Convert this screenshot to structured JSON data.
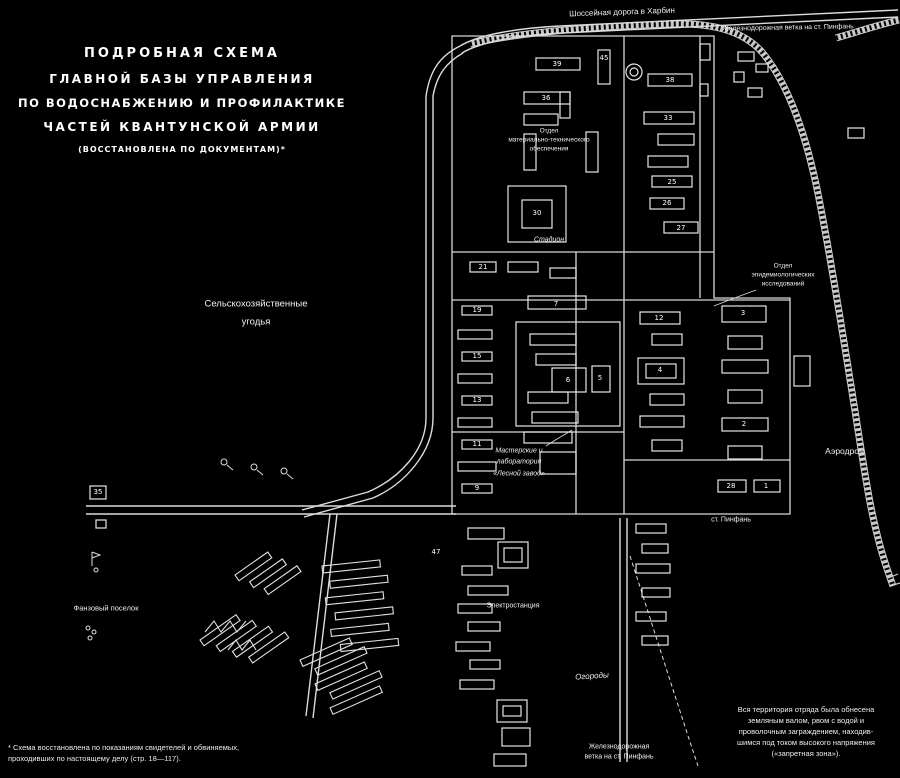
{
  "title": {
    "lines": [
      "ПОДРОБНАЯ СХЕМА",
      "ГЛАВНОЙ БАЗЫ УПРАВЛЕНИЯ",
      "ПО ВОДОСНАБЖЕНИЮ И ПРОФИЛАКТИКЕ",
      "ЧАСТЕЙ КВАНТУНСКОЙ АРМИИ",
      "(ВОССТАНОВЛЕНА ПО ДОКУМЕНТАМ)*"
    ]
  },
  "annotation": {
    "lines": [
      "Вся территория отряда была обнесена",
      "земляным валом, рвом с водой и",
      "проволочным заграждением, находив-",
      "шимся под током высокого напряжения",
      "(«запретная зона»)."
    ]
  },
  "footnote": {
    "lines": [
      "* Схема восстановлена по показаниям свидетелей и обвиняемых,",
      "проходивших по настоящему делу (стр. 18—117)."
    ]
  },
  "map": {
    "colors": {
      "background": "#000000",
      "line": "#dedede",
      "building": "#e6e6e6",
      "text": "#f0f0f0"
    },
    "labels": [
      {
        "id": "farmland-1",
        "text": "Сельскохозяйственные",
        "x": 256,
        "y": 304,
        "size": 9.5
      },
      {
        "id": "farmland-2",
        "text": "угодья",
        "x": 256,
        "y": 322,
        "size": 9.5
      },
      {
        "id": "highway-harbin",
        "text": "Шоссейная дорога в Харбин",
        "x": 622,
        "y": 12,
        "size": 8,
        "rot": -2
      },
      {
        "id": "railway-top",
        "text": "Железнодорожная ветка на ст. Пинфань",
        "x": 788,
        "y": 28,
        "size": 7,
        "rot": -1
      },
      {
        "id": "dept-supply-1",
        "text": "Отдел",
        "x": 549,
        "y": 131,
        "size": 6.5
      },
      {
        "id": "dept-supply-2",
        "text": "материально-технического",
        "x": 549,
        "y": 140,
        "size": 6.5
      },
      {
        "id": "dept-supply-3",
        "text": "обеспечения",
        "x": 549,
        "y": 149,
        "size": 6.5
      },
      {
        "id": "stadium",
        "text": "Стадион",
        "x": 549,
        "y": 240,
        "size": 7,
        "italic": true
      },
      {
        "id": "dept-research-1",
        "text": "Отдел",
        "x": 783,
        "y": 266,
        "size": 6.5
      },
      {
        "id": "dept-research-2",
        "text": "эпидемиологических",
        "x": 783,
        "y": 275,
        "size": 6.5
      },
      {
        "id": "dept-research-3",
        "text": "исследований",
        "x": 783,
        "y": 284,
        "size": 6.5
      },
      {
        "id": "workshops-1",
        "text": "Мастерские и",
        "x": 519,
        "y": 451,
        "size": 7,
        "italic": true
      },
      {
        "id": "workshops-2",
        "text": "лаборатория",
        "x": 519,
        "y": 462,
        "size": 7,
        "italic": true
      },
      {
        "id": "workshops-3",
        "text": "«Лесной завод»",
        "x": 519,
        "y": 474,
        "size": 7,
        "italic": true
      },
      {
        "id": "airfield",
        "text": "Аэродром",
        "x": 845,
        "y": 451,
        "size": 8.5
      },
      {
        "id": "station-pinfan",
        "text": "ст. Пинфань",
        "x": 731,
        "y": 520,
        "size": 7
      },
      {
        "id": "gardens",
        "text": "Огороды",
        "x": 592,
        "y": 676,
        "size": 8,
        "italic": true,
        "rot": -4
      },
      {
        "id": "power-station",
        "text": "Электростанция",
        "x": 513,
        "y": 606,
        "size": 7
      },
      {
        "id": "railway-bottom-1",
        "text": "Железнодорожная",
        "x": 619,
        "y": 747,
        "size": 7
      },
      {
        "id": "railway-bottom-2",
        "text": "ветка на ст. Пинфань",
        "x": 619,
        "y": 757,
        "size": 7
      },
      {
        "id": "fanza-village",
        "text": "Фанзовый поселок",
        "x": 106,
        "y": 608,
        "size": 7.5
      }
    ],
    "building_numbers": [
      {
        "n": "35",
        "x": 98,
        "y": 492
      },
      {
        "n": "39",
        "x": 557,
        "y": 64
      },
      {
        "n": "45",
        "x": 604,
        "y": 58
      },
      {
        "n": "38",
        "x": 670,
        "y": 80
      },
      {
        "n": "36",
        "x": 546,
        "y": 98
      },
      {
        "n": "33",
        "x": 668,
        "y": 118
      },
      {
        "n": "30",
        "x": 537,
        "y": 213
      },
      {
        "n": "27",
        "x": 681,
        "y": 228
      },
      {
        "n": "25",
        "x": 672,
        "y": 182
      },
      {
        "n": "26",
        "x": 667,
        "y": 203
      },
      {
        "n": "21",
        "x": 483,
        "y": 267
      },
      {
        "n": "19",
        "x": 477,
        "y": 310
      },
      {
        "n": "15",
        "x": 477,
        "y": 356
      },
      {
        "n": "13",
        "x": 477,
        "y": 400
      },
      {
        "n": "11",
        "x": 477,
        "y": 444
      },
      {
        "n": "9",
        "x": 477,
        "y": 488
      },
      {
        "n": "7",
        "x": 556,
        "y": 304
      },
      {
        "n": "6",
        "x": 568,
        "y": 380
      },
      {
        "n": "5",
        "x": 600,
        "y": 378
      },
      {
        "n": "4",
        "x": 660,
        "y": 370
      },
      {
        "n": "12",
        "x": 659,
        "y": 318
      },
      {
        "n": "3",
        "x": 743,
        "y": 313
      },
      {
        "n": "2",
        "x": 744,
        "y": 424
      },
      {
        "n": "28",
        "x": 731,
        "y": 486
      },
      {
        "n": "1",
        "x": 766,
        "y": 486
      },
      {
        "n": "47",
        "x": 436,
        "y": 552
      }
    ]
  }
}
